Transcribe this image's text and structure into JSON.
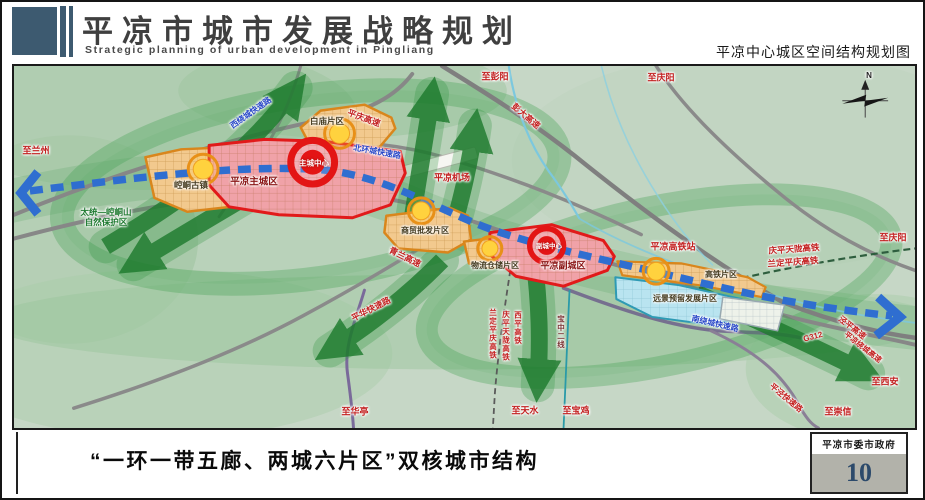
{
  "header": {
    "title": "平凉市城市发展战略规划",
    "subtitle": "Strategic planning of urban development in Pingliang",
    "map_title": "平凉中心城区空间结构规划图"
  },
  "footer": {
    "caption": "“一环一带五廊、两城六片区”双核城市结构",
    "credit": "平凉市委市政府",
    "page_number": "10"
  },
  "colors": {
    "header_accent": "#3d5a70",
    "page_number_blue": "#2c4a6b",
    "map_background": "#c6d7c6",
    "corridor_green": "#1c7a2c",
    "ring_green": "#3f9e4f",
    "transit_blue": "#2f6ed0",
    "core_red": "#e31515",
    "city_pink": "#f0a2a8",
    "district_orange": "#f2c98e",
    "district_orange_border": "#d9861c",
    "reserve_blue": "#b9e4f0",
    "road_gray": "#878787",
    "label_red": "#c32020",
    "label_blue": "#2847c8",
    "label_green": "#1e7a30"
  },
  "map": {
    "labels": [
      {
        "id": "label-to-lanzhou",
        "text": "至兰州",
        "type": "red",
        "x": 22,
        "y": 85,
        "size": 9
      },
      {
        "id": "label-nature-reserve",
        "text": "太统—崆峒山\n自然保护区",
        "type": "green",
        "x": 92,
        "y": 151,
        "size": 8.5
      },
      {
        "id": "label-kongtong-old-town",
        "text": "崆峒古镇",
        "type": "district",
        "x": 177,
        "y": 119,
        "size": 8.5
      },
      {
        "id": "label-main-city",
        "text": "平凉主城区",
        "type": "city",
        "x": 240,
        "y": 116,
        "size": 9.5
      },
      {
        "id": "label-main-core",
        "text": "主城中心",
        "type": "core",
        "x": 300,
        "y": 97,
        "size": 7.5
      },
      {
        "id": "label-baimiao-district",
        "text": "白庙片区",
        "type": "district",
        "x": 313,
        "y": 55,
        "size": 8.5
      },
      {
        "id": "label-west-ring-road",
        "text": "西绕城快速路",
        "type": "blue",
        "x": 237,
        "y": 47,
        "rot": -35,
        "size": 8
      },
      {
        "id": "label-north-ring-road",
        "text": "北环城快速路",
        "type": "blue",
        "x": 363,
        "y": 86,
        "rot": 10,
        "size": 8
      },
      {
        "id": "label-pingqing-expressway",
        "text": "平庆高速",
        "type": "red",
        "x": 350,
        "y": 52,
        "rot": 20,
        "size": 8.5
      },
      {
        "id": "label-to-pengyang",
        "text": "至彭阳",
        "type": "red",
        "x": 481,
        "y": 11,
        "size": 9
      },
      {
        "id": "label-pengda-expressway",
        "text": "彭大高速",
        "type": "red",
        "x": 512,
        "y": 50,
        "rot": 40,
        "size": 8.5
      },
      {
        "id": "label-to-qingyang-top",
        "text": "至庆阳",
        "type": "red",
        "x": 647,
        "y": 12,
        "size": 9
      },
      {
        "id": "label-airport",
        "text": "平凉机场",
        "type": "red",
        "x": 438,
        "y": 112,
        "size": 9
      },
      {
        "id": "label-trade-district",
        "text": "商贸批发片区",
        "type": "district",
        "x": 411,
        "y": 165,
        "size": 8
      },
      {
        "id": "label-qinglan-expressway",
        "text": "青兰高速",
        "type": "red",
        "x": 391,
        "y": 191,
        "rot": 26,
        "size": 8.5
      },
      {
        "id": "label-logistics-district",
        "text": "物流仓储片区",
        "type": "district",
        "x": 481,
        "y": 200,
        "size": 8
      },
      {
        "id": "label-sub-city",
        "text": "平凉副城区",
        "type": "city",
        "x": 549,
        "y": 200,
        "size": 9
      },
      {
        "id": "label-sub-core",
        "text": "副城中心",
        "type": "core",
        "x": 535,
        "y": 181,
        "size": 6.5
      },
      {
        "id": "label-hsr-station",
        "text": "平凉高铁站",
        "type": "red",
        "x": 659,
        "y": 181,
        "size": 9
      },
      {
        "id": "label-hsr-district",
        "text": "高铁片区",
        "type": "district",
        "x": 707,
        "y": 209,
        "size": 8
      },
      {
        "id": "label-reserve-district",
        "text": "远景预留发展片区",
        "type": "district",
        "x": 671,
        "y": 233,
        "size": 8
      },
      {
        "id": "label-qingping-tianlong-hsr",
        "text": "庆平天陇高铁",
        "type": "red",
        "x": 780,
        "y": 183,
        "rot": -4,
        "size": 8.5
      },
      {
        "id": "label-landing-pingqing-hsr",
        "text": "兰定平庆高铁",
        "type": "red",
        "x": 779,
        "y": 196,
        "rot": -4,
        "size": 8.5
      },
      {
        "id": "label-to-qingyang-right",
        "text": "至庆阳",
        "type": "red",
        "x": 879,
        "y": 172,
        "size": 9
      },
      {
        "id": "label-g312",
        "text": "G312",
        "type": "red",
        "x": 799,
        "y": 271,
        "rot": -15,
        "size": 8
      },
      {
        "id": "label-jingping-expressway",
        "text": "泾平高速",
        "type": "red",
        "x": 838,
        "y": 262,
        "rot": 38,
        "size": 8
      },
      {
        "id": "label-ring-expressway",
        "text": "平凉绕城高速",
        "type": "red",
        "x": 849,
        "y": 281,
        "rot": 38,
        "size": 7.5
      },
      {
        "id": "label-to-xian",
        "text": "至西安",
        "type": "red",
        "x": 871,
        "y": 316,
        "size": 9
      },
      {
        "id": "label-to-chongxin",
        "text": "至崇信",
        "type": "red",
        "x": 824,
        "y": 346,
        "size": 9
      },
      {
        "id": "label-pingjing-road",
        "text": "平泾快速路",
        "type": "red",
        "x": 772,
        "y": 332,
        "rot": 40,
        "size": 8
      },
      {
        "id": "label-south-ring-road",
        "text": "南绕城快速路",
        "type": "blue",
        "x": 701,
        "y": 258,
        "rot": 13,
        "size": 8
      },
      {
        "id": "label-pinghua-road",
        "text": "平华快速路",
        "type": "red",
        "x": 357,
        "y": 243,
        "rot": -27,
        "size": 8.5
      },
      {
        "id": "label-to-huating",
        "text": "至华亭",
        "type": "red",
        "x": 341,
        "y": 346,
        "size": 9
      },
      {
        "id": "label-to-tianshui",
        "text": "至天水",
        "type": "red",
        "x": 511,
        "y": 345,
        "size": 9
      },
      {
        "id": "label-to-baoji",
        "text": "至宝鸡",
        "type": "red",
        "x": 562,
        "y": 345,
        "size": 9
      },
      {
        "id": "label-landing-pingqing-hsr-v",
        "text": "兰定平庆高铁",
        "type": "red",
        "x": 479,
        "y": 268,
        "vertical": true,
        "size": 7.5
      },
      {
        "id": "label-qingping-tianlong-hsr-v",
        "text": "庆平天陇高铁",
        "type": "red",
        "x": 492,
        "y": 270,
        "vertical": true,
        "size": 7.5
      },
      {
        "id": "label-xiping-hsr-v",
        "text": "西平高铁",
        "type": "red",
        "x": 504,
        "y": 262,
        "vertical": true,
        "size": 7.5
      },
      {
        "id": "label-baozhong-line-v",
        "text": "宝中二线",
        "type": "maroon",
        "x": 547,
        "y": 266,
        "vertical": true,
        "size": 7.5
      },
      {
        "id": "label-compass-n",
        "text": "N",
        "type": "dark",
        "x": 855,
        "y": 10,
        "size": 8
      }
    ]
  }
}
